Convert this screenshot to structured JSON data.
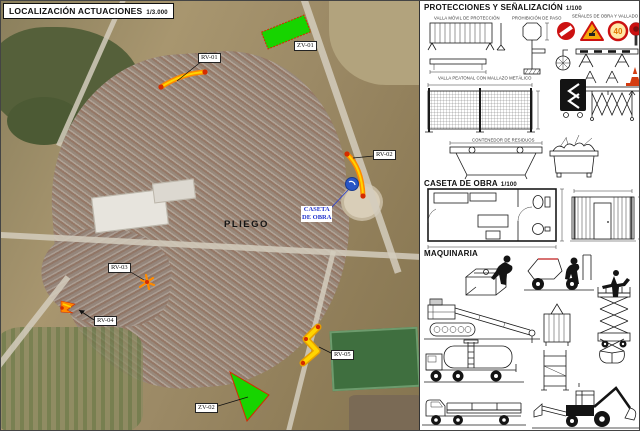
{
  "map": {
    "title": "LOCALIZACIÓN ACTUACIONES",
    "scale": "1/3.000",
    "town": "PLIEGO",
    "caseta_line1": "CASETA",
    "caseta_line2": "DE OBRA",
    "markers": {
      "rv01": "RV-01",
      "rv02": "RV-02",
      "rv03": "RV-03",
      "rv04": "RV-04",
      "rv05": "RV-05",
      "zv01": "ZV-01",
      "zv02": "ZV-02"
    }
  },
  "panel": {
    "protections": {
      "title": "PROTECCIONES Y SEÑALIZACIÓN",
      "scale": "1/100",
      "labels": {
        "valla_movil": "VALLA MÓVIL DE PROTECCIÓN",
        "prohibicion": "PROHIBICIÓN DE PASO",
        "senales": "SEÑALES DE OBRA Y VALLADO",
        "valla_peaton": "VALLA PEATONAL CON MALLAZO METÁLICO",
        "contenedor": "CONTENEDOR DE RESIDUOS"
      },
      "speed_sign": "40"
    },
    "caseta": {
      "title": "CASETA DE OBRA",
      "scale": "1/100"
    },
    "maquinaria": {
      "title": "MAQUINARIA"
    }
  },
  "colors": {
    "action_green": "#17d400",
    "action_orange": "#ff8a00",
    "action_yellow": "#ffd400",
    "marker_red": "#d42b00",
    "caseta_blue": "#2a56c6",
    "sign_red": "#cc1111",
    "sign_amber": "#f6a80a"
  }
}
